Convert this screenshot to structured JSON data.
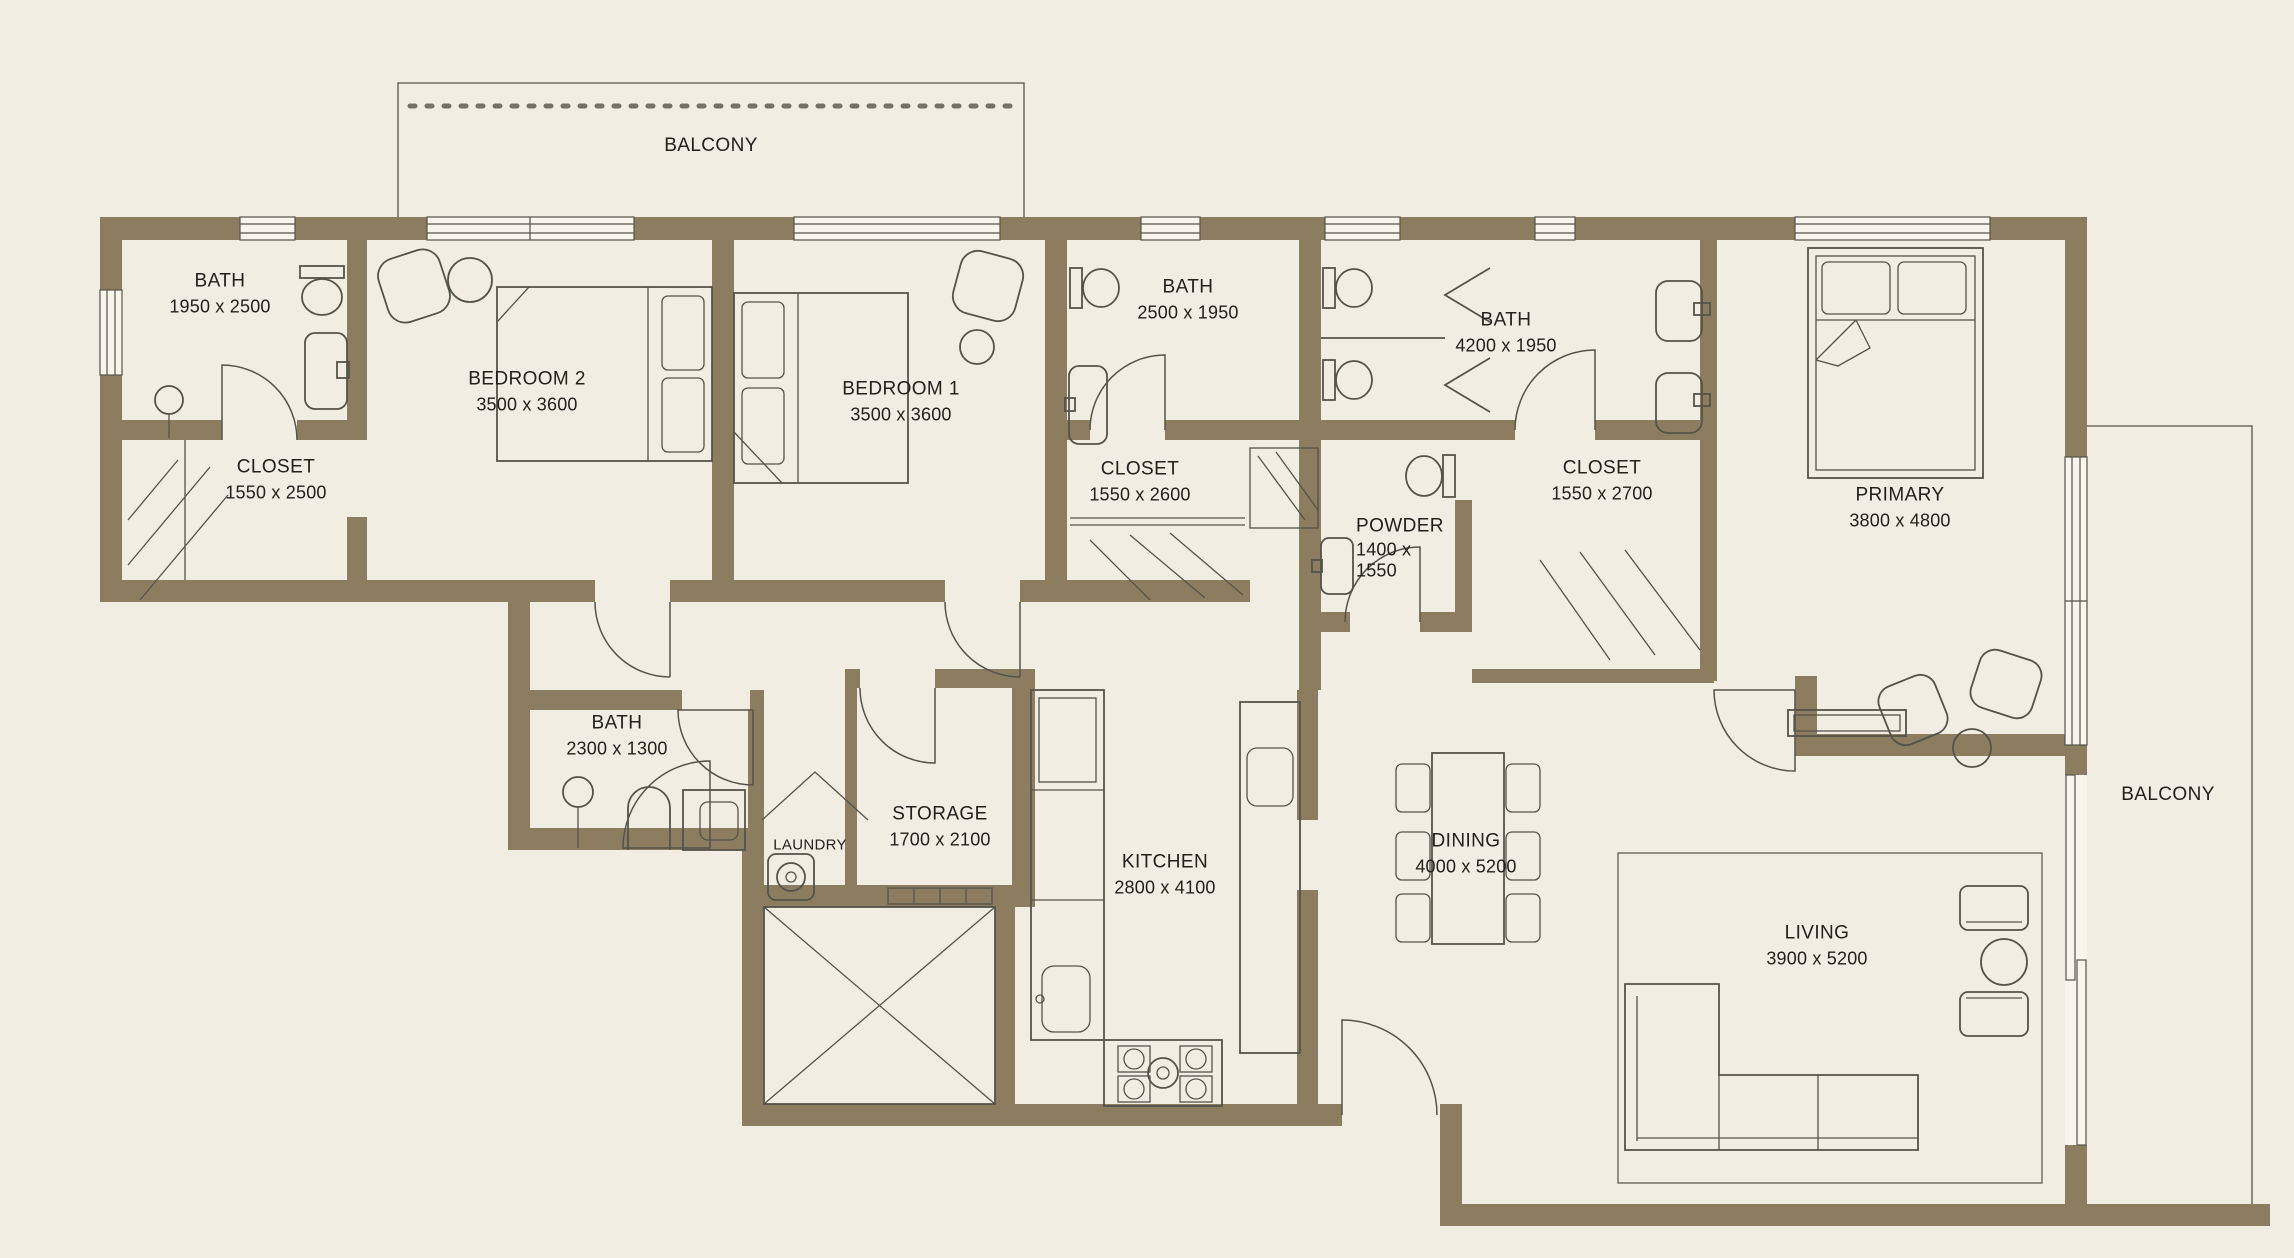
{
  "colors": {
    "wall": "#8c7d61",
    "bg": "#f2ede2",
    "line": "#54534a",
    "window": "#f9f5ec",
    "text": "#22211c"
  },
  "rooms": {
    "bath_top_left": {
      "label": "BATH",
      "dims": "1950 x 2500"
    },
    "closet_top_left": {
      "label": "CLOSET",
      "dims": "1550 x 2500"
    },
    "bedroom2": {
      "label": "BEDROOM 2",
      "dims": "3500 x 3600"
    },
    "bedroom1": {
      "label": "BEDROOM 1",
      "dims": "3500 x 3600"
    },
    "bath_mid": {
      "label": "BATH",
      "dims": "2500 x 1950"
    },
    "bath_double": {
      "label": "BATH",
      "dims": "4200 x 1950"
    },
    "closet_mid": {
      "label": "CLOSET",
      "dims": "1550 x 2600"
    },
    "powder": {
      "label": "POWDER",
      "dims": "1400 x 1550"
    },
    "closet_primary": {
      "label": "CLOSET",
      "dims": "1550 x 2700"
    },
    "primary": {
      "label": "PRIMARY",
      "dims": "3800 x 4800"
    },
    "bath_small": {
      "label": "BATH",
      "dims": "2300 x 1300"
    },
    "laundry": {
      "label": "LAUNDRY"
    },
    "storage": {
      "label": "STORAGE",
      "dims": "1700 x 2100"
    },
    "kitchen": {
      "label": "KITCHEN",
      "dims": "2800 x 4100"
    },
    "dining": {
      "label": "DINING",
      "dims": "4000 x 5200"
    },
    "living": {
      "label": "LIVING",
      "dims": "3900 x 5200"
    },
    "balcony_top": {
      "label": "BALCONY"
    },
    "balcony_right": {
      "label": "BALCONY"
    }
  }
}
